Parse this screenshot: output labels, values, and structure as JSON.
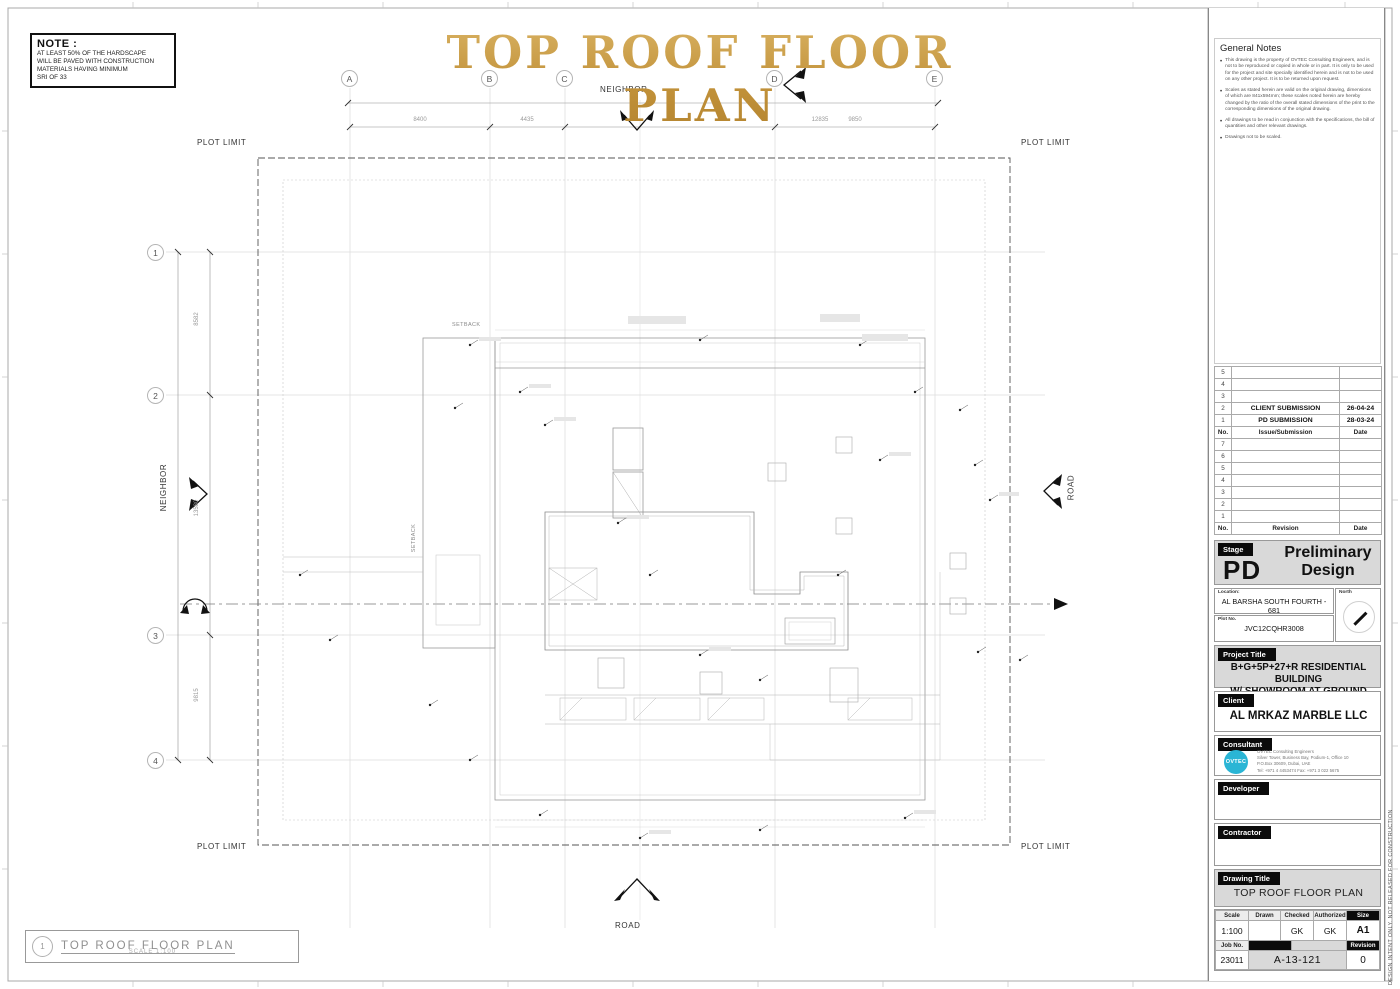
{
  "sheet": {
    "main_title": "TOP ROOF  FLOOR PLAN",
    "disclaimer_vertical": "DESIGN INTENT ONLY. NOT RELEASED FOR CONSTRUCTION"
  },
  "note_box": {
    "heading": "NOTE :",
    "lines": [
      "AT LEAST 50% OF THE HARDSCAPE",
      "WILL BE PAVED WITH CONSTRUCTION",
      "MATERIALS HAVING MINIMUM",
      "SRI OF 33"
    ]
  },
  "grid": {
    "columns": [
      "A",
      "B",
      "C",
      "D",
      "E"
    ],
    "rows": [
      "1",
      "2",
      "3",
      "4"
    ]
  },
  "dimensions": {
    "top": [
      "8400",
      "4435",
      "12835",
      "9850"
    ],
    "left": [
      "8582",
      "13580",
      "9815"
    ]
  },
  "site_labels": {
    "neighbor_top": "NEIGHBOR",
    "neighbor_left": "NEIGHBOR",
    "road_right": "ROAD",
    "road_bottom": "ROAD",
    "plot_limit_tl": "PLOT LIMIT",
    "plot_limit_tr": "PLOT LIMIT",
    "plot_limit_bl": "PLOT LIMIT",
    "plot_limit_br": "PLOT LIMIT",
    "setback_top": "SETBACK",
    "setback_left": "SETBACK"
  },
  "footer_label": {
    "detail_no": "1",
    "title": "TOP ROOF  FLOOR PLAN",
    "scale": "SCALE 1:100"
  },
  "titleblock": {
    "general_notes": {
      "heading": "General Notes",
      "bullets": [
        "This drawing is the property of OVTEC Consulting Engineers, and is not to be reproduced or copied in whole or in part. It is only to be used for the project and site specially identified herein and is not to be used on any other project. It is to be returned upon request.",
        "Scales as stated herein are valid on the original drawing, dimensions of which are 841x594mm; these scales noted herein are hereby changed by the ratio of the overall stated dimensions of the print to the corresponding dimensions of the original drawing.",
        "All drawings to be read in conjunction with the specifications, the bill of quantities and other relevant drawings.",
        "Drawings not to be scaled."
      ]
    },
    "issue_table": {
      "rows": [
        {
          "no": "5",
          "label": "",
          "date": ""
        },
        {
          "no": "4",
          "label": "",
          "date": ""
        },
        {
          "no": "3",
          "label": "",
          "date": ""
        },
        {
          "no": "2",
          "label": "CLIENT  SUBMISSION",
          "date": "26-04-24"
        },
        {
          "no": "1",
          "label": "PD SUBMISSION",
          "date": "28-03-24"
        }
      ],
      "header": {
        "no": "No.",
        "label": "Issue/Submission",
        "date": "Date"
      }
    },
    "revision_table": {
      "rows": [
        {
          "no": "7"
        },
        {
          "no": "6"
        },
        {
          "no": "5"
        },
        {
          "no": "4"
        },
        {
          "no": "3"
        },
        {
          "no": "2"
        },
        {
          "no": "1"
        }
      ],
      "header": {
        "no": "No.",
        "label": "Revision",
        "date": "Date"
      }
    },
    "stage": {
      "label": "Stage",
      "code": "PD",
      "name": "Preliminary Design"
    },
    "location": {
      "label": "Location:",
      "value": "AL BARSHA SOUTH FOURTH - 681"
    },
    "north": {
      "label": "North"
    },
    "plot": {
      "label": "Plot No.",
      "value": "JVC12CQHR3008"
    },
    "project": {
      "label": "Project Title",
      "line1": "B+G+5P+27+R RESIDENTIAL BUILDING",
      "line2": "W/ SHOWROOM AT GROUND"
    },
    "client": {
      "label": "Client",
      "value": "AL MRKAZ MARBLE LLC"
    },
    "consultant": {
      "label": "Consultant",
      "logo_text": "OVTEC",
      "lines": [
        "OVTEC Consulting Engineers",
        "Silver Tower, Business Bay, Podium-1, Office 10",
        "P.O.Box 30609, Dubai, UAE",
        "Tel: +971 4 4453474        Fax: +971 3 022 5675"
      ]
    },
    "developer": {
      "label": "Developer"
    },
    "contractor": {
      "label": "Contractor"
    },
    "drawing_title": {
      "label": "Drawing Title",
      "value": "TOP ROOF FLOOR PLAN"
    },
    "info": {
      "scale_label": "Scale",
      "scale": "1:100",
      "drawn_label": "Drawn",
      "drawn": "",
      "checked_label": "Checked",
      "checked": "GK",
      "authorized_label": "Authorized",
      "authorized": "GK",
      "size_label": "Size",
      "size": "A1",
      "job_label": "Job No.",
      "job": "23011",
      "drawing_no": "A-13-121",
      "revision_label": "Revision",
      "revision": "0"
    }
  },
  "colors": {
    "title_gold": "#c59a3f",
    "logo_cyan": "#2ab5d5",
    "chip_black": "#0b0b0b",
    "panel_gray": "#d9d9d9"
  }
}
